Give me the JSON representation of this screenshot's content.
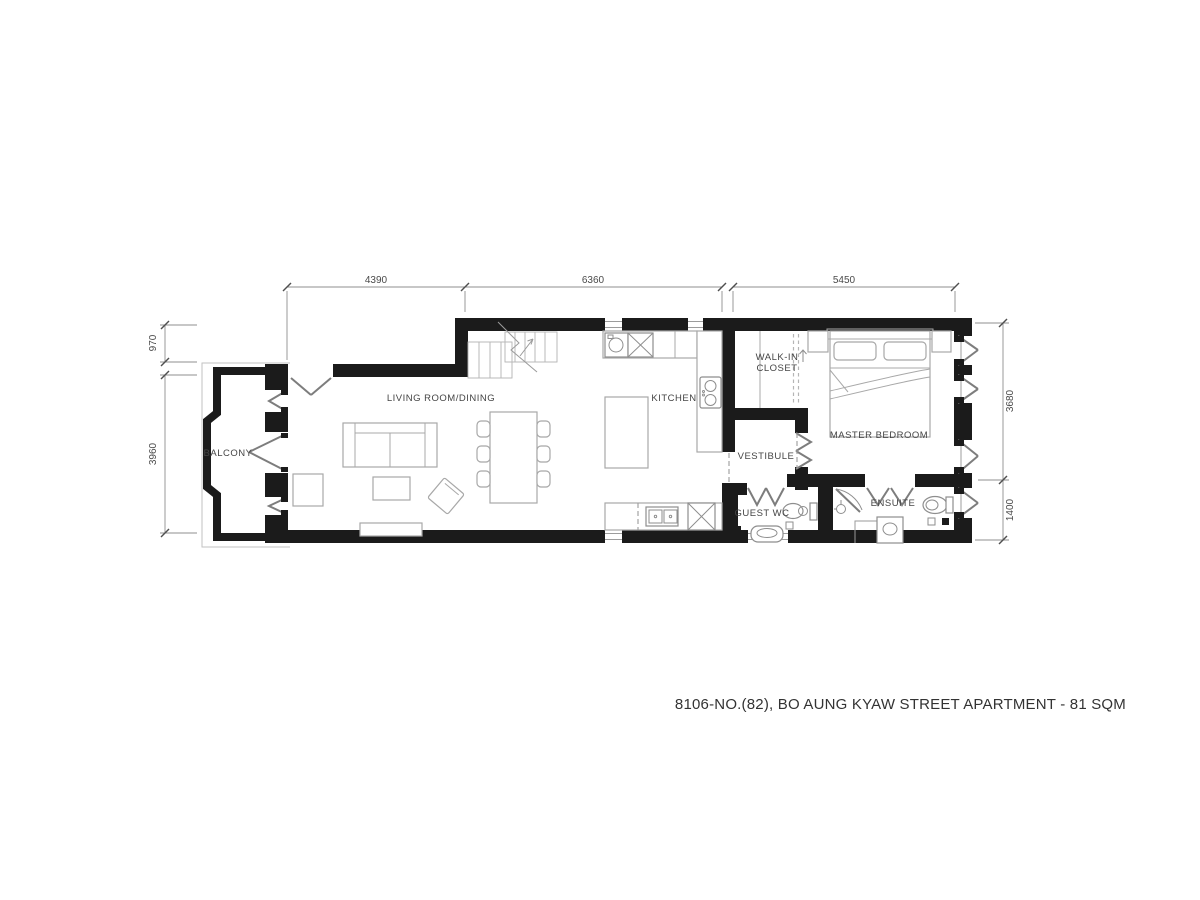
{
  "title": "8106-NO.(82), BO AUNG KYAW STREET APARTMENT - 81 SQM",
  "rooms": {
    "balcony": "BALCONY",
    "living_dining": "LIVING ROOM/DINING",
    "kitchen": "KITCHEN",
    "walk_in_closet_line1": "WALK-IN",
    "walk_in_closet_line2": "CLOSET",
    "master_bedroom": "MASTER BEDROOM",
    "vestibule": "VESTIBULE",
    "guest_wc": "GUEST WC",
    "ensuite": "ENSUITE"
  },
  "dimensions": {
    "top": [
      "4390",
      "6360",
      "5450"
    ],
    "left": [
      "970",
      "3960"
    ],
    "right": [
      "3680",
      "1400"
    ]
  },
  "colors": {
    "wall": "#1b1b1b",
    "furniture_line": "#a8a8a8",
    "fixture_line": "#8e8e8e",
    "door_line": "#7d7d7d",
    "dimension_line": "#8f8f8f",
    "label_text": "#454545",
    "background": "#ffffff"
  }
}
